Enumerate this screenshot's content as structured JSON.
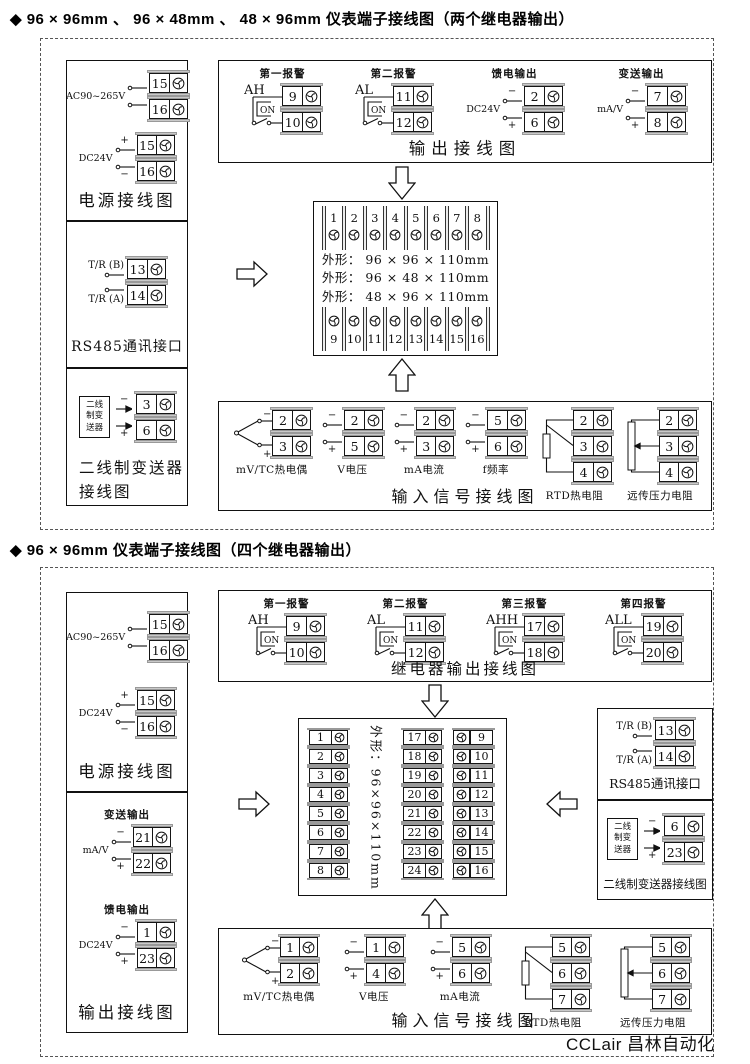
{
  "watermark": "CCLair 昌林自动化",
  "icons": {
    "terminal_screw": "screw-icon",
    "block_arrow_down": "⇩",
    "block_arrow_up": "⇧",
    "block_arrow_right": "⇨",
    "block_arrow_left": "⇦"
  },
  "sections": [
    {
      "title": "◆ 96 × 96mm 、 96 × 48mm 、 48 × 96mm 仪表端子接线图（两个继电器输出）",
      "power_box": {
        "caption": "电源接线图",
        "groups": [
          {
            "type": "wires2",
            "label": "AC90~265V",
            "top_sign": "",
            "bottom_sign": "",
            "terminals": [
              15,
              16
            ]
          },
          {
            "type": "wires2",
            "label": "DC24V",
            "top_sign": "+",
            "bottom_sign": "−",
            "terminals": [
              15,
              16
            ]
          }
        ]
      },
      "rs485_box": {
        "caption": "RS485通讯接口",
        "rows": [
          {
            "label": "T/R (B)",
            "wire": "below",
            "terminal": 13
          },
          {
            "label": "T/R (A)",
            "wire": "above",
            "terminal": 14
          }
        ]
      },
      "transmitter_box": {
        "caption_lines": [
          "二线制变送器",
          "接线图"
        ],
        "device_label_lines": [
          "二线",
          "制变",
          "送器"
        ],
        "rows": [
          {
            "sign": "−",
            "terminal": 3
          },
          {
            "sign": "+",
            "terminal": 6
          }
        ]
      },
      "output_box": {
        "caption": "输出接线图",
        "groups": [
          {
            "type": "alarm",
            "title": "第一报警",
            "side": "AH",
            "switch": "ON",
            "terminals": [
              9,
              10
            ]
          },
          {
            "type": "alarm",
            "title": "第二报警",
            "side": "AL",
            "switch": "ON",
            "terminals": [
              11,
              12
            ]
          },
          {
            "type": "wires2",
            "title": "馈电输出",
            "label": "DC24V",
            "top_sign": "−",
            "bottom_sign": "+",
            "terminals": [
              2,
              6
            ]
          },
          {
            "type": "wires2",
            "title": "变送输出",
            "label": "mA/V",
            "top_sign": "−",
            "bottom_sign": "+",
            "terminals": [
              7,
              8
            ]
          }
        ]
      },
      "terminal_block": {
        "top_row": [
          1,
          2,
          3,
          4,
          5,
          6,
          7,
          8
        ],
        "shape_lines": [
          "外形： 96 × 96 × 110mm",
          "外形： 96 × 48 × 110mm",
          "外形： 48 × 96 × 110mm"
        ],
        "bottom_row": [
          9,
          10,
          11,
          12,
          13,
          14,
          15,
          16
        ]
      },
      "input_box": {
        "caption": "输入信号接线图",
        "groups": [
          {
            "type": "tc",
            "name": "mV/TC热电偶",
            "top_sign": "−",
            "bottom_sign": "+",
            "terminals": [
              2,
              3
            ]
          },
          {
            "type": "wires2",
            "name": "V电压",
            "top_sign": "−",
            "bottom_sign": "+",
            "terminals": [
              2,
              5
            ]
          },
          {
            "type": "wires2",
            "name": "mA电流",
            "top_sign": "−",
            "bottom_sign": "+",
            "terminals": [
              2,
              3
            ]
          },
          {
            "type": "wires2",
            "name": "f频率",
            "top_sign": "−",
            "bottom_sign": "+",
            "terminals": [
              5,
              6
            ]
          },
          {
            "type": "rtd",
            "name": "RTD热电阻",
            "terminals": [
              2,
              3,
              4
            ]
          },
          {
            "type": "pot",
            "name": "远传压力电阻",
            "terminals": [
              2,
              3,
              4
            ]
          }
        ]
      }
    },
    {
      "title": "◆ 96 × 96mm 仪表端子接线图（四个继电器输出）",
      "power_box": {
        "caption": "电源接线图",
        "groups": [
          {
            "type": "wires2",
            "label": "AC90~265V",
            "top_sign": "",
            "bottom_sign": "",
            "terminals": [
              15,
              16
            ]
          },
          {
            "type": "wires2",
            "label": "DC24V",
            "top_sign": "+",
            "bottom_sign": "−",
            "terminals": [
              15,
              16
            ]
          }
        ]
      },
      "output_box_left": {
        "caption": "输出接线图",
        "groups": [
          {
            "type": "wires2",
            "title": "变送输出",
            "label": "mA/V",
            "top_sign": "−",
            "bottom_sign": "+",
            "terminals": [
              21,
              22
            ]
          },
          {
            "type": "wires2",
            "title": "馈电输出",
            "label": "DC24V",
            "top_sign": "−",
            "bottom_sign": "+",
            "terminals": [
              1,
              23
            ]
          }
        ]
      },
      "relay_box": {
        "caption": "继电器输出接线图",
        "groups": [
          {
            "type": "alarm",
            "title": "第一报警",
            "side": "AH",
            "switch": "ON",
            "terminals": [
              9,
              10
            ]
          },
          {
            "type": "alarm",
            "title": "第二报警",
            "side": "AL",
            "switch": "ON",
            "terminals": [
              11,
              12
            ]
          },
          {
            "type": "alarm",
            "title": "第三报警",
            "side": "AHH",
            "switch": "ON",
            "terminals": [
              17,
              18
            ]
          },
          {
            "type": "alarm",
            "title": "第四报警",
            "side": "ALL",
            "switch": "ON",
            "terminals": [
              19,
              20
            ]
          }
        ]
      },
      "terminal_block": {
        "left_column": [
          1,
          2,
          3,
          4,
          5,
          6,
          7,
          8
        ],
        "middle_column": [
          17,
          18,
          19,
          20,
          21,
          22,
          23,
          24
        ],
        "right_column": [
          9,
          10,
          11,
          12,
          13,
          14,
          15,
          16
        ],
        "shape_text": "外形：96×96×110mm"
      },
      "rs485_box": {
        "caption": "RS485通讯接口",
        "rows": [
          {
            "label": "T/R (B)",
            "wire": "below",
            "terminal": 13
          },
          {
            "label": "T/R (A)",
            "wire": "above",
            "terminal": 14
          }
        ]
      },
      "transmitter_box": {
        "caption_lines": [
          "二线制变送器接线图"
        ],
        "device_label_lines": [
          "二线",
          "制变",
          "送器"
        ],
        "rows": [
          {
            "sign": "−",
            "terminal": 6
          },
          {
            "sign": "+",
            "terminal": 23
          }
        ]
      },
      "input_box": {
        "caption": "输入信号接线图",
        "groups": [
          {
            "type": "tc",
            "name": "mV/TC热电偶",
            "top_sign": "−",
            "bottom_sign": "+",
            "terminals": [
              1,
              2
            ]
          },
          {
            "type": "wires2",
            "name": "V电压",
            "top_sign": "−",
            "bottom_sign": "+",
            "terminals": [
              1,
              4
            ]
          },
          {
            "type": "wires2",
            "name": "mA电流",
            "top_sign": "−",
            "bottom_sign": "+",
            "terminals": [
              5,
              6
            ]
          },
          {
            "type": "rtd",
            "name": "RTD热电阻",
            "terminals": [
              5,
              6,
              7
            ]
          },
          {
            "type": "pot",
            "name": "远传压力电阻",
            "terminals": [
              5,
              6,
              7
            ]
          }
        ]
      }
    }
  ]
}
